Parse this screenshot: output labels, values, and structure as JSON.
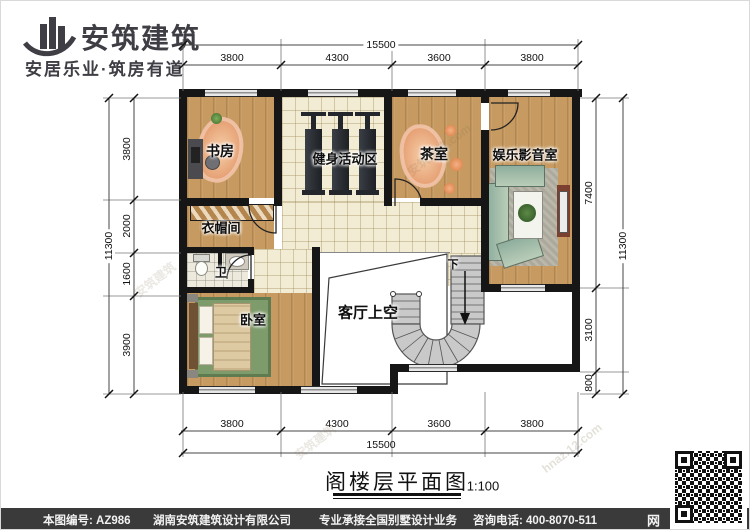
{
  "brand": {
    "name": "安筑建筑",
    "slogan": "安居乐业·筑房有道"
  },
  "titleblock": {
    "title": "阁楼层平面图",
    "scale": "1:100"
  },
  "rooms": {
    "study": "书房",
    "gym": "健身活动区",
    "tea": "茶室",
    "media": "娱乐影音室",
    "cloakroom": "衣帽间",
    "bath": "卫",
    "bedroom": "卧室",
    "living_void": "客厅上空",
    "stair_down": "下"
  },
  "dims": {
    "top": {
      "total": "15500",
      "segments": [
        "3800",
        "4300",
        "3600",
        "3800"
      ]
    },
    "bottom": {
      "total": "15500",
      "segments": [
        "3800",
        "4300",
        "3600",
        "3800"
      ]
    },
    "left": {
      "total": "11300",
      "segments": [
        "3800",
        "2000",
        "1600",
        "3900"
      ]
    },
    "right": {
      "total": "11300",
      "segments": [
        "7400",
        "3100",
        "800"
      ]
    }
  },
  "footer": {
    "drawing_no": "本图编号: AZ986",
    "company": "湖南安筑建筑设计有限公司",
    "service": "专业承接全国别墅设计业务",
    "phone": "咨询电话: 400-8070-511",
    "web_char": "网"
  },
  "watermarks": [
    "安筑建筑",
    "安筑建筑.com",
    "hnaz.12.com",
    "安筑建筑"
  ],
  "colors": {
    "wall": "#161616",
    "wood": "#c69a60",
    "tile": "#f3ecd4",
    "accent": "#e08756",
    "footer_bg": "#3a3a3a"
  }
}
